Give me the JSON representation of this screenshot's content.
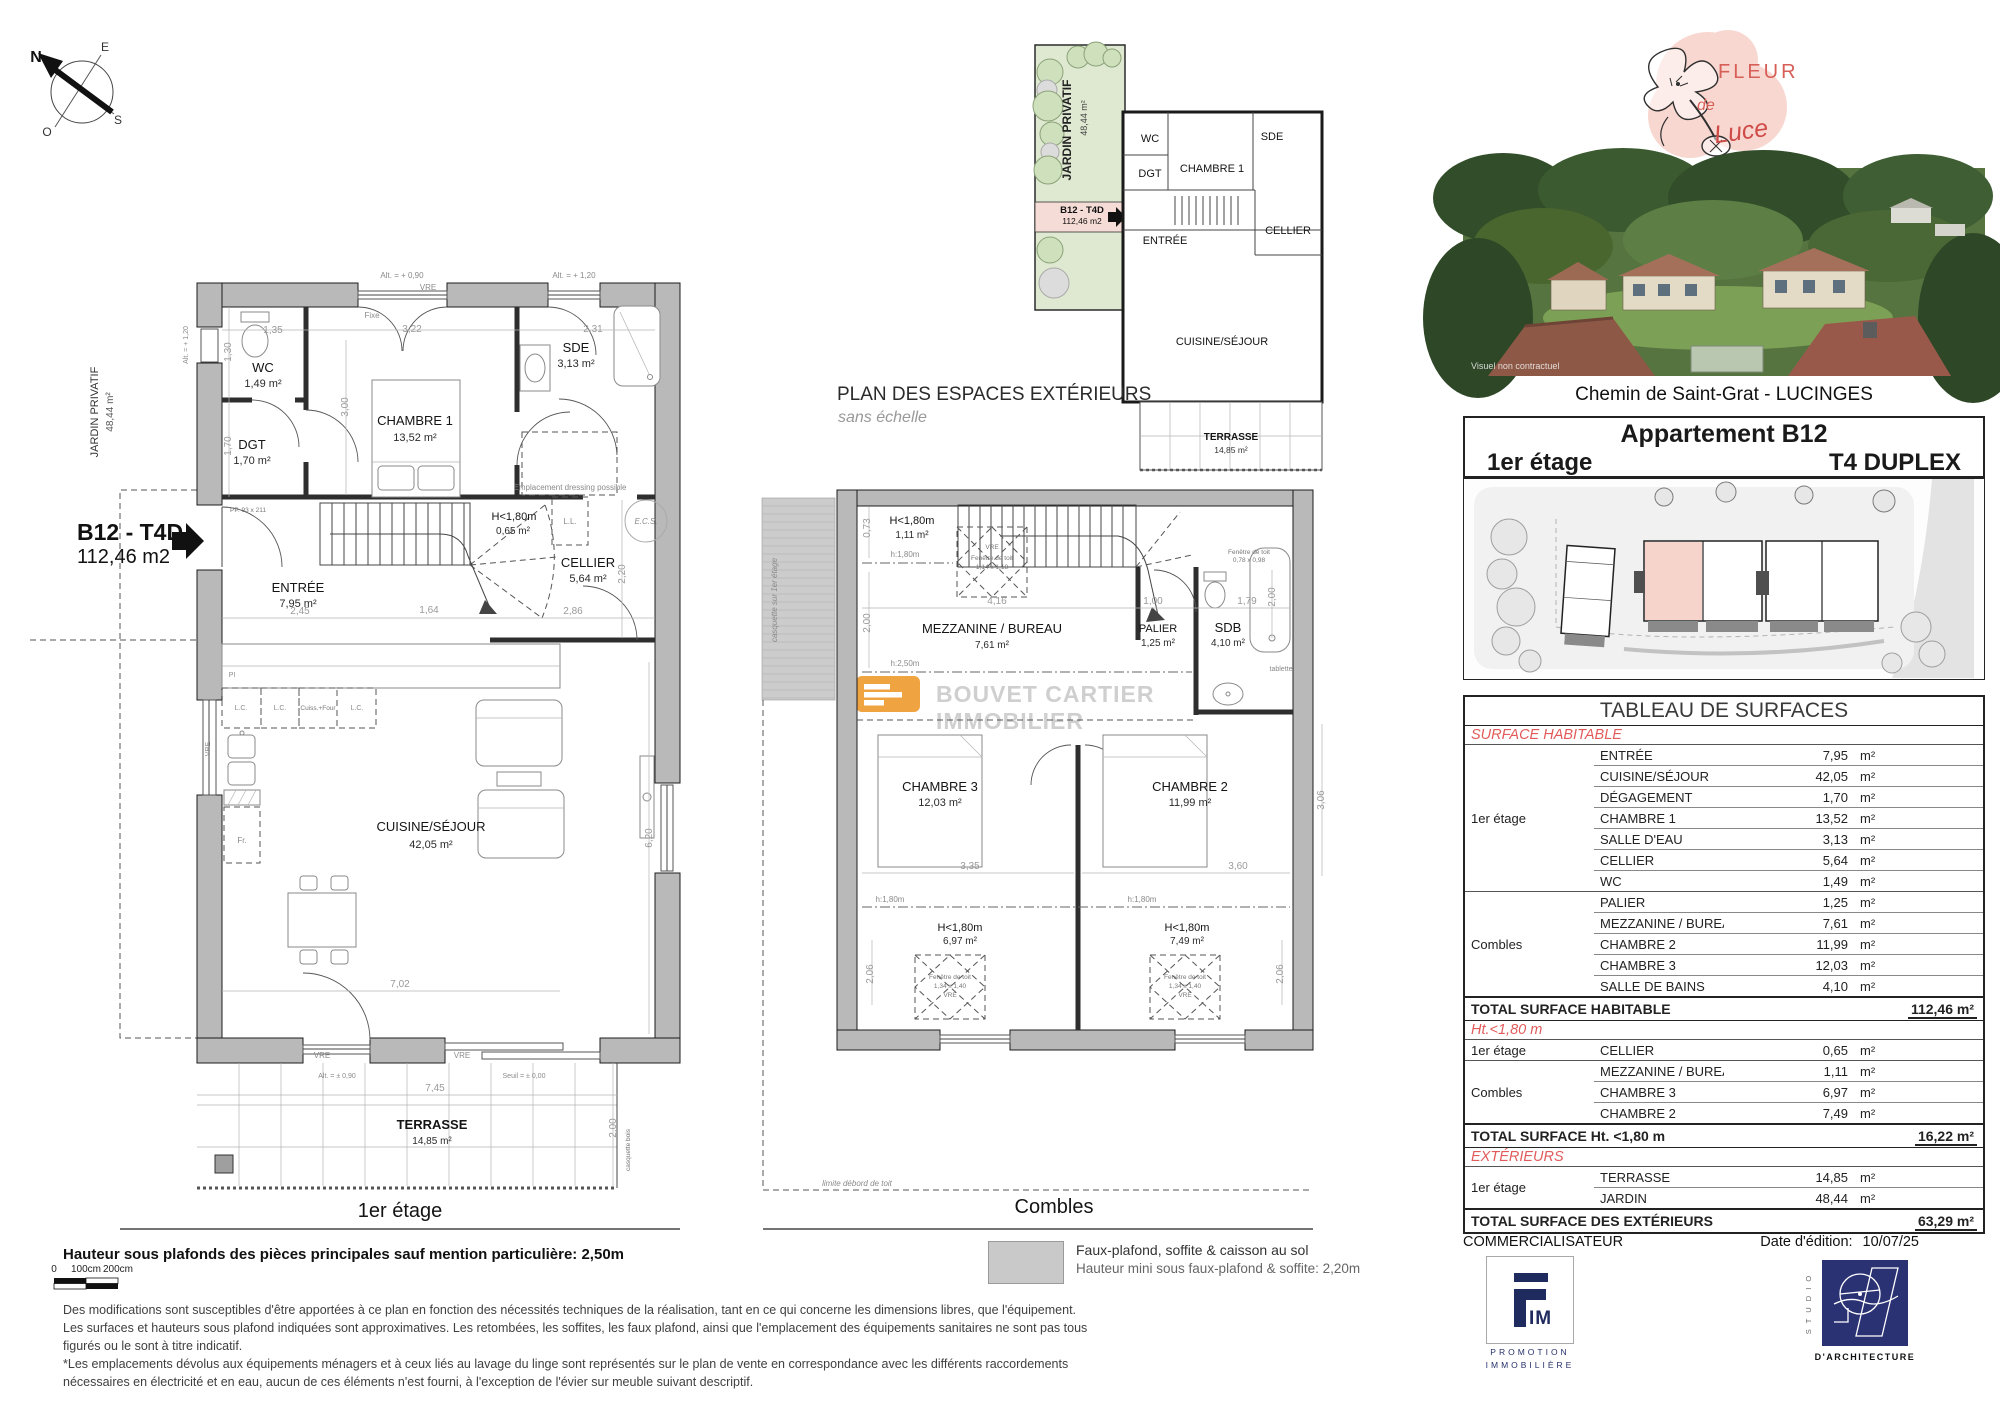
{
  "compass": {
    "n": "N",
    "e": "E",
    "s": "S",
    "o": "O"
  },
  "side": {
    "jardin": "JARDIN PRIVATIF",
    "jardin_area": "48,44 m²",
    "tag_code": "B12 - T4D",
    "tag_area": "112,46 m2"
  },
  "etage": {
    "title": "1er étage",
    "rooms": [
      {
        "n": "WC",
        "a": "1,49 m²"
      },
      {
        "n": "DGT",
        "a": "1,70 m²"
      },
      {
        "n": "CHAMBRE 1",
        "a": "13,52 m²"
      },
      {
        "n": "SDE",
        "a": "3,13 m²"
      },
      {
        "n": "H<1,80m",
        "a": "0,65 m²"
      },
      {
        "n": "CELLIER",
        "a": "5,64 m²"
      },
      {
        "n": "ENTRÉE",
        "a": "7,95 m²"
      },
      {
        "n": "CUISINE/SÉJOUR",
        "a": "42,05 m²"
      },
      {
        "n": "TERRASSE",
        "a": "14,85 m²"
      }
    ],
    "dims": [
      "1,35",
      "3,22",
      "2,31",
      "1,30",
      "3,00",
      "1,70",
      "2,45",
      "1,64",
      "2,86",
      "2,20",
      "6,20",
      "7,02",
      "7,45",
      "2,00"
    ],
    "ann": {
      "alt090": "Alt. = + 0,90",
      "alt120": "Alt. = + 1,20",
      "vre": "VRE",
      "fixe": "Fixe",
      "dressing": "Emplacement dressing possible",
      "ll": "L.L.",
      "ecs": "E.C.S.",
      "pi": "PI",
      "lc": "L.C.",
      "four": "Cuiss.+Four",
      "fr": "Fr.",
      "pp": "PP. 93 x 211",
      "alt_pm": "Alt. = ± 0,90",
      "seuil": "Seuil = ± 0,00",
      "casq_bois": "casquette bois"
    }
  },
  "combles": {
    "title": "Combles",
    "rooms": [
      {
        "n": "H<1,80m",
        "a": "1,11 m²"
      },
      {
        "n": "MEZZANINE / BUREAU",
        "a": "7,61 m²"
      },
      {
        "n": "PALIER",
        "a": "1,25 m²"
      },
      {
        "n": "SDB",
        "a": "4,10 m²"
      },
      {
        "n": "CHAMBRE 3",
        "a": "12,03 m²"
      },
      {
        "n": "CHAMBRE 2",
        "a": "11,99 m²"
      },
      {
        "n": "H<1,80m",
        "a": "6,97 m²"
      },
      {
        "n": "H<1,80m",
        "a": "7,49 m²"
      }
    ],
    "dims": [
      "0,73",
      "4,16",
      "2,00",
      "1,00",
      "1,79",
      "2,00",
      "3,35",
      "3,60",
      "2,06",
      "2,06",
      "3,06"
    ],
    "ann": {
      "h180": "h:1,80m",
      "h250": "h:2,50m",
      "tablette": "tablette",
      "casquette": "casquette sur 1er étage",
      "limite": "limite débord de toit",
      "roof": "Fenêtre de toit",
      "roof1_size": "1,14 x 1,18",
      "roof2_size": "1,34 x 1,40",
      "roof3_size": "0,78 x 0,98",
      "vre": "VRE"
    }
  },
  "exterior": {
    "title": "PLAN DES ESPACES EXTÉRIEURS",
    "subtitle": "sans échelle",
    "jardin": "JARDIN PRIVATIF",
    "jardin_area": "48,44 m²",
    "tag_code": "B12 - T4D",
    "tag_area": "112,46 m2",
    "rooms": [
      "WC",
      "DGT",
      "CHAMBRE 1",
      "SDE",
      "ENTRÉE",
      "CELLIER",
      "CUISINE/SÉJOUR"
    ],
    "terrasse": "TERRASSE",
    "terrasse_area": "14,85 m²"
  },
  "watermark": {
    "l1": "BOUVET CARTIER",
    "l2": "IMMOBILIER"
  },
  "panel": {
    "brand": {
      "fleur": "FLEUR",
      "de": "de",
      "luce": "Luce"
    },
    "photo_caption": "Visuel non contractuel",
    "address": "Chemin de Saint-Grat - LUCINGES",
    "apartment": {
      "title": "Appartement B12",
      "floor": "1er étage",
      "type": "T4 DUPLEX"
    },
    "table": {
      "title": "TABLEAU DE SURFACES",
      "unit": "m²",
      "sections": [
        {
          "title": "SURFACE HABITABLE",
          "groups": [
            {
              "name": "1er étage",
              "rows": [
                [
                  "ENTRÉE",
                  "7,95"
                ],
                [
                  "CUISINE/SÉJOUR",
                  "42,05"
                ],
                [
                  "DÉGAGEMENT",
                  "1,70"
                ],
                [
                  "CHAMBRE 1",
                  "13,52"
                ],
                [
                  "SALLE D'EAU",
                  "3,13"
                ],
                [
                  "CELLIER",
                  "5,64"
                ],
                [
                  "WC",
                  "1,49"
                ]
              ]
            },
            {
              "name": "Combles",
              "rows": [
                [
                  "PALIER",
                  "1,25"
                ],
                [
                  "MEZZANINE / BUREAU",
                  "7,61"
                ],
                [
                  "CHAMBRE 2",
                  "11,99"
                ],
                [
                  "CHAMBRE 3",
                  "12,03"
                ],
                [
                  "SALLE DE BAINS",
                  "4,10"
                ]
              ]
            }
          ],
          "total": {
            "label": "TOTAL SURFACE HABITABLE",
            "value": "112,46 m²"
          }
        },
        {
          "title": "Ht.<1,80 m",
          "groups": [
            {
              "name": "1er étage",
              "rows": [
                [
                  "CELLIER",
                  "0,65"
                ]
              ]
            },
            {
              "name": "Combles",
              "rows": [
                [
                  "MEZZANINE / BUREAU",
                  "1,11"
                ],
                [
                  "CHAMBRE 3",
                  "6,97"
                ],
                [
                  "CHAMBRE 2",
                  "7,49"
                ]
              ]
            }
          ],
          "total": {
            "label": "TOTAL SURFACE Ht. <1,80 m",
            "value": "16,22 m²"
          }
        },
        {
          "title": "EXTÉRIEURS",
          "groups": [
            {
              "name": "1er étage",
              "rows": [
                [
                  "TERRASSE",
                  "14,85"
                ],
                [
                  "JARDIN",
                  "48,44"
                ]
              ]
            }
          ],
          "total": {
            "label": "TOTAL SURFACE  DES EXTÉRIEURS",
            "value": "63,29 m²"
          }
        }
      ]
    },
    "commercialisateur": "COMMERCIALISATEUR",
    "edition_label": "Date d'édition:",
    "edition_value": "10/07/25",
    "fim": {
      "im": "IM",
      "line1": "PROMOTION",
      "line2": "IMMOBILIÈRE"
    },
    "studio": {
      "side": "S T U D I O",
      "bottom": "D'ARCHITECTURE"
    }
  },
  "notes": {
    "height_note": "Hauteur sous plafonds des pièces principales sauf mention particulière: 2,50m",
    "scale": [
      "0",
      "100cm",
      "200cm"
    ],
    "legend1": "Faux-plafond, soffite & caisson au sol",
    "legend2": "Hauteur mini sous faux-plafond & soffite: 2,20m",
    "disclaimer": [
      "Des modifications sont susceptibles d'être apportées à ce plan en fonction des nécessités techniques de la réalisation, tant en ce qui concerne les dimensions libres, que l'équipement.",
      "Les surfaces et hauteurs sous plafond indiquées sont approximatives. Les retombées, les soffites, les faux plafond, ainsi que l'emplacement des équipements sanitaires ne sont pas tous figurés ou le sont à titre indicatif.",
      "*Les emplacements dévolus aux équipements ménagers et à ceux liés au lavage du linge sont représentés sur le plan de vente en correspondance avec les différents raccordements",
      "nécessaires en électricité et en eau, aucun de ces éléments n'est fourni, à l'exception de l'évier sur meuble suivant descriptif."
    ]
  }
}
